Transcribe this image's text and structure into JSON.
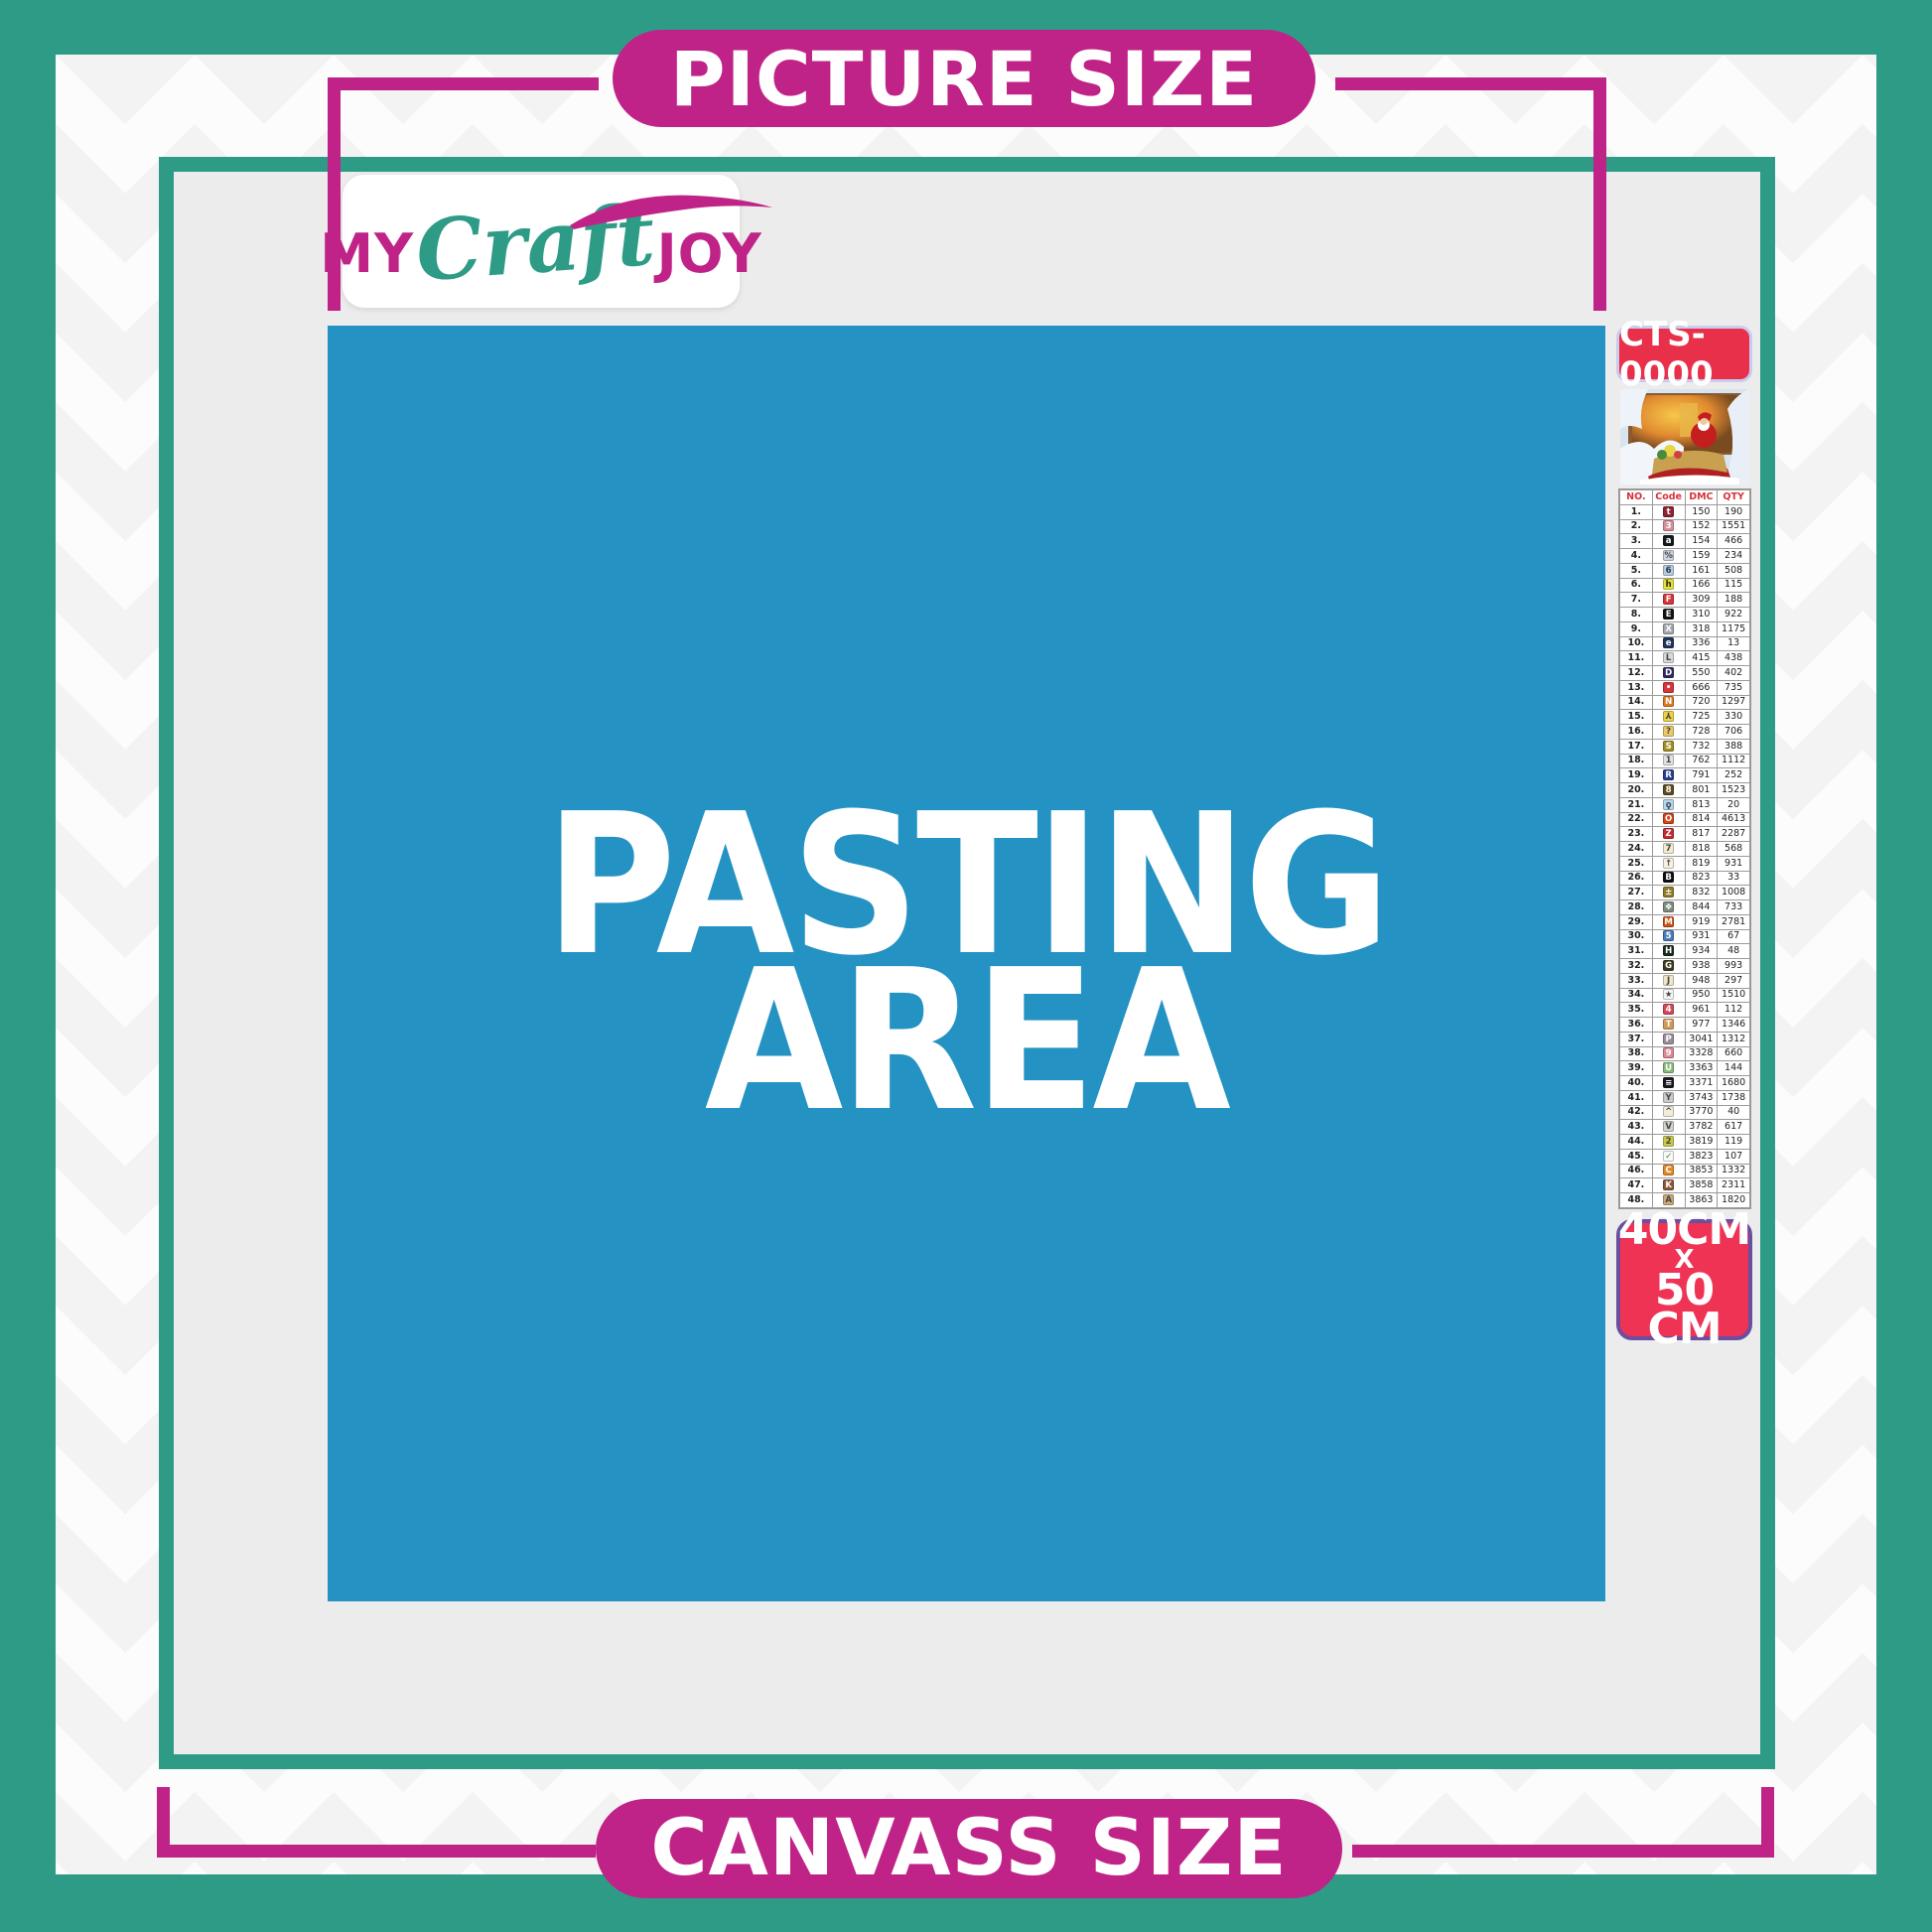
{
  "colors": {
    "teal": "#2E9B86",
    "magenta": "#C02387",
    "blue": "#2492C2",
    "red": "#E8304B",
    "size_badge_bg": "#EE3355",
    "size_badge_border": "#6A4EA0",
    "inner_gray": "#ECECEC"
  },
  "banners": {
    "top": "PICTURE SIZE",
    "bottom": "CANVASS SIZE"
  },
  "logo": {
    "my": "MY",
    "craft": "Craft",
    "joy": "JOY"
  },
  "pasting_area": {
    "line1": "PASTING",
    "line2": "AREA"
  },
  "sidebar": {
    "kit_code": "CTS-0000",
    "size": {
      "l1": "40CM",
      "l2": "X",
      "l3": "50 CM"
    },
    "table": {
      "headers": [
        "NO.",
        "Code",
        "DMC",
        "QTY"
      ],
      "rows": [
        {
          "no": "1.",
          "sym": "t",
          "bg": "#8E2430",
          "fg": "#FFFFFF",
          "dmc": "150",
          "qty": "190"
        },
        {
          "no": "2.",
          "sym": "3",
          "bg": "#D89098",
          "fg": "#FFFFFF",
          "dmc": "152",
          "qty": "1551"
        },
        {
          "no": "3.",
          "sym": "a",
          "bg": "#17181C",
          "fg": "#FFFFFF",
          "dmc": "154",
          "qty": "466"
        },
        {
          "no": "4.",
          "sym": "%",
          "bg": "#CDD6DE",
          "fg": "#444444",
          "dmc": "159",
          "qty": "234"
        },
        {
          "no": "5.",
          "sym": "6",
          "bg": "#B8CCDE",
          "fg": "#223B55",
          "dmc": "161",
          "qty": "508"
        },
        {
          "no": "6.",
          "sym": "h",
          "bg": "#E6E23A",
          "fg": "#222222",
          "dmc": "166",
          "qty": "115"
        },
        {
          "no": "7.",
          "sym": "F",
          "bg": "#D7343C",
          "fg": "#FFFFFF",
          "dmc": "309",
          "qty": "188"
        },
        {
          "no": "8.",
          "sym": "E",
          "bg": "#121316",
          "fg": "#FFFFFF",
          "dmc": "310",
          "qty": "922"
        },
        {
          "no": "9.",
          "sym": "X",
          "bg": "#A3A7AB",
          "fg": "#FFFFFF",
          "dmc": "318",
          "qty": "1175"
        },
        {
          "no": "10.",
          "sym": "e",
          "bg": "#20365E",
          "fg": "#FFFFFF",
          "dmc": "336",
          "qty": "13"
        },
        {
          "no": "11.",
          "sym": "L",
          "bg": "#D9D9D9",
          "fg": "#444444",
          "dmc": "415",
          "qty": "438"
        },
        {
          "no": "12.",
          "sym": "D",
          "bg": "#332B60",
          "fg": "#FFFFFF",
          "dmc": "550",
          "qty": "402"
        },
        {
          "no": "13.",
          "sym": "•",
          "bg": "#D7343C",
          "fg": "#FFFFFF",
          "dmc": "666",
          "qty": "735"
        },
        {
          "no": "14.",
          "sym": "N",
          "bg": "#DE7A22",
          "fg": "#FFFFFF",
          "dmc": "720",
          "qty": "1297"
        },
        {
          "no": "15.",
          "sym": "⅄",
          "bg": "#EFD243",
          "fg": "#444444",
          "dmc": "725",
          "qty": "330"
        },
        {
          "no": "16.",
          "sym": "?",
          "bg": "#E9C96B",
          "fg": "#444444",
          "dmc": "728",
          "qty": "706"
        },
        {
          "no": "17.",
          "sym": "S",
          "bg": "#A08E24",
          "fg": "#FFFFFF",
          "dmc": "732",
          "qty": "388"
        },
        {
          "no": "18.",
          "sym": "1",
          "bg": "#E2E2E2",
          "fg": "#444444",
          "dmc": "762",
          "qty": "1112"
        },
        {
          "no": "19.",
          "sym": "R",
          "bg": "#2A3E8E",
          "fg": "#FFFFFF",
          "dmc": "791",
          "qty": "252"
        },
        {
          "no": "20.",
          "sym": "8",
          "bg": "#5E4C20",
          "fg": "#FFFFFF",
          "dmc": "801",
          "qty": "1523"
        },
        {
          "no": "21.",
          "sym": "ϙ",
          "bg": "#BCD6E9",
          "fg": "#33506B",
          "dmc": "813",
          "qty": "20"
        },
        {
          "no": "22.",
          "sym": "O",
          "bg": "#CF4419",
          "fg": "#FFFFFF",
          "dmc": "814",
          "qty": "4613"
        },
        {
          "no": "23.",
          "sym": "Z",
          "bg": "#C22A32",
          "fg": "#FFFFFF",
          "dmc": "817",
          "qty": "2287"
        },
        {
          "no": "24.",
          "sym": "7",
          "bg": "#F2EAD2",
          "fg": "#444444",
          "dmc": "818",
          "qty": "568"
        },
        {
          "no": "25.",
          "sym": "↑",
          "bg": "#F6F1E2",
          "fg": "#444444",
          "dmc": "819",
          "qty": "931"
        },
        {
          "no": "26.",
          "sym": "B",
          "bg": "#0F0F12",
          "fg": "#FFFFFF",
          "dmc": "823",
          "qty": "33"
        },
        {
          "no": "27.",
          "sym": "±",
          "bg": "#8D7D2A",
          "fg": "#FFFFFF",
          "dmc": "832",
          "qty": "1008"
        },
        {
          "no": "28.",
          "sym": "❖",
          "bg": "#7E8C7E",
          "fg": "#FFFFFF",
          "dmc": "844",
          "qty": "733"
        },
        {
          "no": "29.",
          "sym": "M",
          "bg": "#C65419",
          "fg": "#FFFFFF",
          "dmc": "919",
          "qty": "2781"
        },
        {
          "no": "30.",
          "sym": "5",
          "bg": "#4A7AB8",
          "fg": "#FFFFFF",
          "dmc": "931",
          "qty": "67"
        },
        {
          "no": "31.",
          "sym": "H",
          "bg": "#1C2B1C",
          "fg": "#FFFFFF",
          "dmc": "934",
          "qty": "48"
        },
        {
          "no": "32.",
          "sym": "G",
          "bg": "#3C3C22",
          "fg": "#FFFFFF",
          "dmc": "938",
          "qty": "993"
        },
        {
          "no": "33.",
          "sym": "J",
          "bg": "#F0E6CA",
          "fg": "#444444",
          "dmc": "948",
          "qty": "297"
        },
        {
          "no": "34.",
          "sym": "★",
          "bg": "#F6F6F6",
          "fg": "#444444",
          "dmc": "950",
          "qty": "1510"
        },
        {
          "no": "35.",
          "sym": "4",
          "bg": "#D24A5A",
          "fg": "#FFFFFF",
          "dmc": "961",
          "qty": "112"
        },
        {
          "no": "36.",
          "sym": "T",
          "bg": "#D29A5A",
          "fg": "#FFFFFF",
          "dmc": "977",
          "qty": "1346"
        },
        {
          "no": "37.",
          "sym": "P",
          "bg": "#9C8C9A",
          "fg": "#FFFFFF",
          "dmc": "3041",
          "qty": "1312"
        },
        {
          "no": "38.",
          "sym": "9",
          "bg": "#DA8A92",
          "fg": "#FFFFFF",
          "dmc": "3328",
          "qty": "660"
        },
        {
          "no": "39.",
          "sym": "U",
          "bg": "#8ABA7A",
          "fg": "#FFFFFF",
          "dmc": "3363",
          "qty": "144"
        },
        {
          "no": "40.",
          "sym": "≡",
          "bg": "#1A1A1C",
          "fg": "#FFFFFF",
          "dmc": "3371",
          "qty": "1680"
        },
        {
          "no": "41.",
          "sym": "Y",
          "bg": "#CACACA",
          "fg": "#444444",
          "dmc": "3743",
          "qty": "1738"
        },
        {
          "no": "42.",
          "sym": "^",
          "bg": "#F1EDDA",
          "fg": "#444444",
          "dmc": "3770",
          "qty": "40"
        },
        {
          "no": "43.",
          "sym": "V",
          "bg": "#D2D2CE",
          "fg": "#444444",
          "dmc": "3782",
          "qty": "617"
        },
        {
          "no": "44.",
          "sym": "2",
          "bg": "#CACA4A",
          "fg": "#444444",
          "dmc": "3819",
          "qty": "119"
        },
        {
          "no": "45.",
          "sym": "✓",
          "bg": "#FAFAFA",
          "fg": "#2A8A2A",
          "dmc": "3823",
          "qty": "107"
        },
        {
          "no": "46.",
          "sym": "C",
          "bg": "#E28A2A",
          "fg": "#FFFFFF",
          "dmc": "3853",
          "qty": "1332"
        },
        {
          "no": "47.",
          "sym": "K",
          "bg": "#8C5A3A",
          "fg": "#FFFFFF",
          "dmc": "3858",
          "qty": "2311"
        },
        {
          "no": "48.",
          "sym": "A",
          "bg": "#CAAA7A",
          "fg": "#444444",
          "dmc": "3863",
          "qty": "1820"
        }
      ]
    }
  }
}
